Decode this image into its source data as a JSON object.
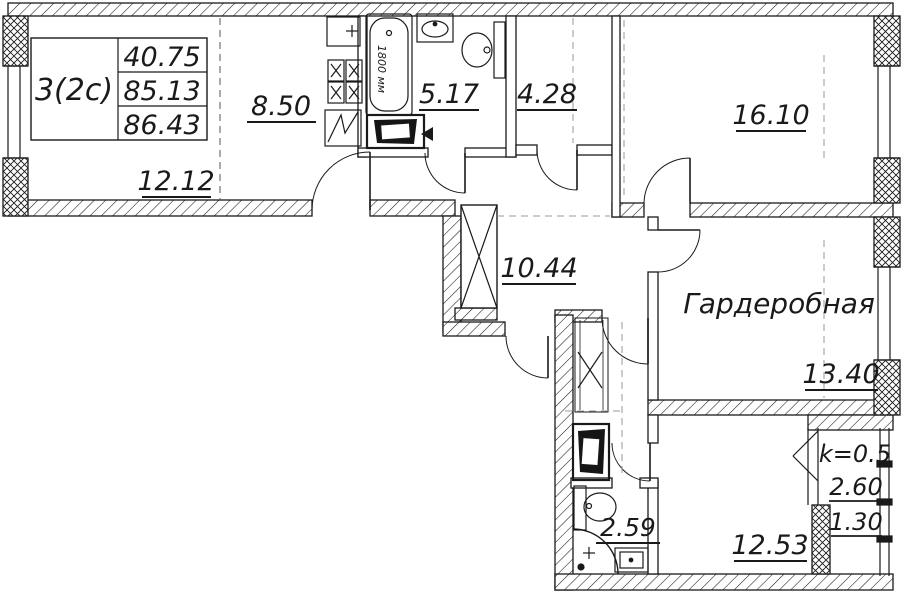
{
  "plan": {
    "unit": {
      "type": "3(2c)",
      "living_area": "40.75",
      "apartment_area": "85.13",
      "total_area": "86.43"
    },
    "rooms": {
      "living": "12.12",
      "kitchen": "8.50",
      "bathroom": "5.17",
      "hall": "4.28",
      "bedroom1": "16.10",
      "corridor": "10.44",
      "wardrobe_name": "Гардеробная",
      "wardrobe": "13.40",
      "wc": "2.59",
      "bedroom2": "12.53",
      "balcony_k": "k=0.5",
      "balcony_area": "2.60",
      "balcony_reduced": "1.30"
    },
    "annotations": {
      "bathtub_length": "1800 мм"
    },
    "colors": {
      "line": "#1a1a1a",
      "zone_line": "#999999",
      "background": "#ffffff"
    }
  }
}
